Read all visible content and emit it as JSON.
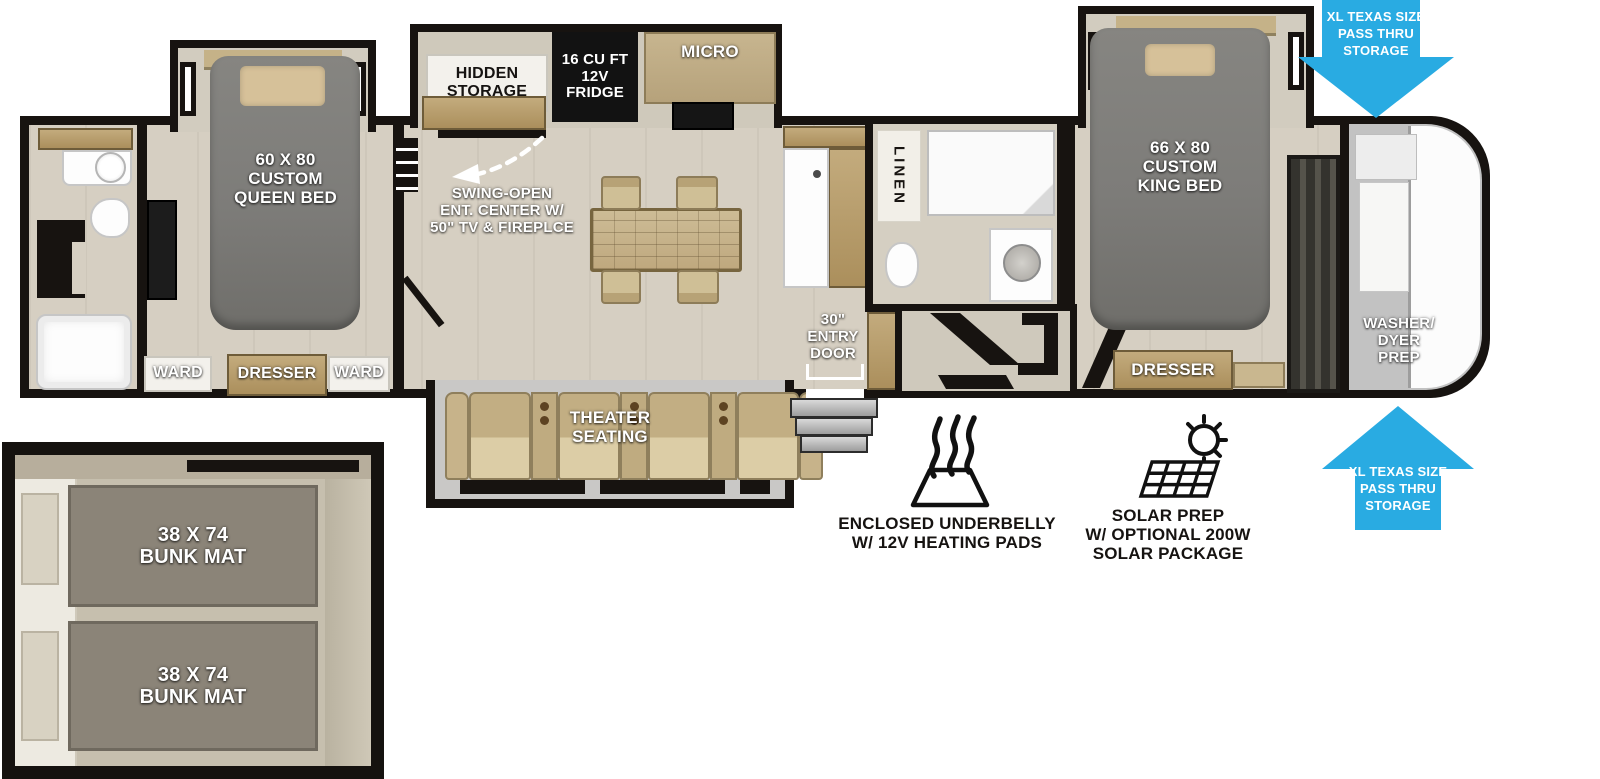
{
  "meta": {
    "type": "rv-travel-trailer-floorplan"
  },
  "colors": {
    "arrow_blue": "#29abe2",
    "wall_black": "#171310",
    "floor_tan": "#d6cfc2",
    "bed_gray": "#7d7c79",
    "cabinet_wood": "#b59a6a",
    "seat_tan": "#cdbb92"
  },
  "storage_arrows": {
    "top_label": "XL TEXAS SIZE\nPASS THRU\nSTORAGE",
    "bottom_label": "XL TEXAS SIZE\nPASS THRU\nSTORAGE"
  },
  "rear_bedroom": {
    "bed_label": "60 X 80\nCUSTOM\nQUEEN BED",
    "ward_left": "WARD",
    "dresser": "DRESSER",
    "ward_right": "WARD"
  },
  "living_kitchen": {
    "hidden_storage": "HIDDEN\nSTORAGE",
    "fridge": "16 CU FT\n12V\nFRIDGE",
    "micro": "MICRO",
    "entertainment_note": "SWING-OPEN\nENT. CENTER W/\n50\" TV & FIREPLCE",
    "entry_door": "30\"\nENTRY\nDOOR",
    "theater": "THEATER\nSEATING"
  },
  "mid_bathroom": {
    "linen": "LINEN"
  },
  "front_bedroom": {
    "bed_label": "66 X 80\nCUSTOM\nKING BED",
    "dresser": "DRESSER"
  },
  "front_cap": {
    "washer_dryer": "WASHER/\nDYER\nPREP"
  },
  "bunk_room": {
    "top_mat": "38 X 74\nBUNK MAT",
    "bottom_mat": "38 X 74\nBUNK MAT"
  },
  "features": {
    "underbelly": {
      "icon": "heating-pads-icon",
      "label": "ENCLOSED UNDERBELLY\nW/ 12V HEATING PADS"
    },
    "solar": {
      "icon": "solar-panel-sun-icon",
      "label": "SOLAR PREP\nW/ OPTIONAL 200W\nSOLAR PACKAGE"
    }
  }
}
